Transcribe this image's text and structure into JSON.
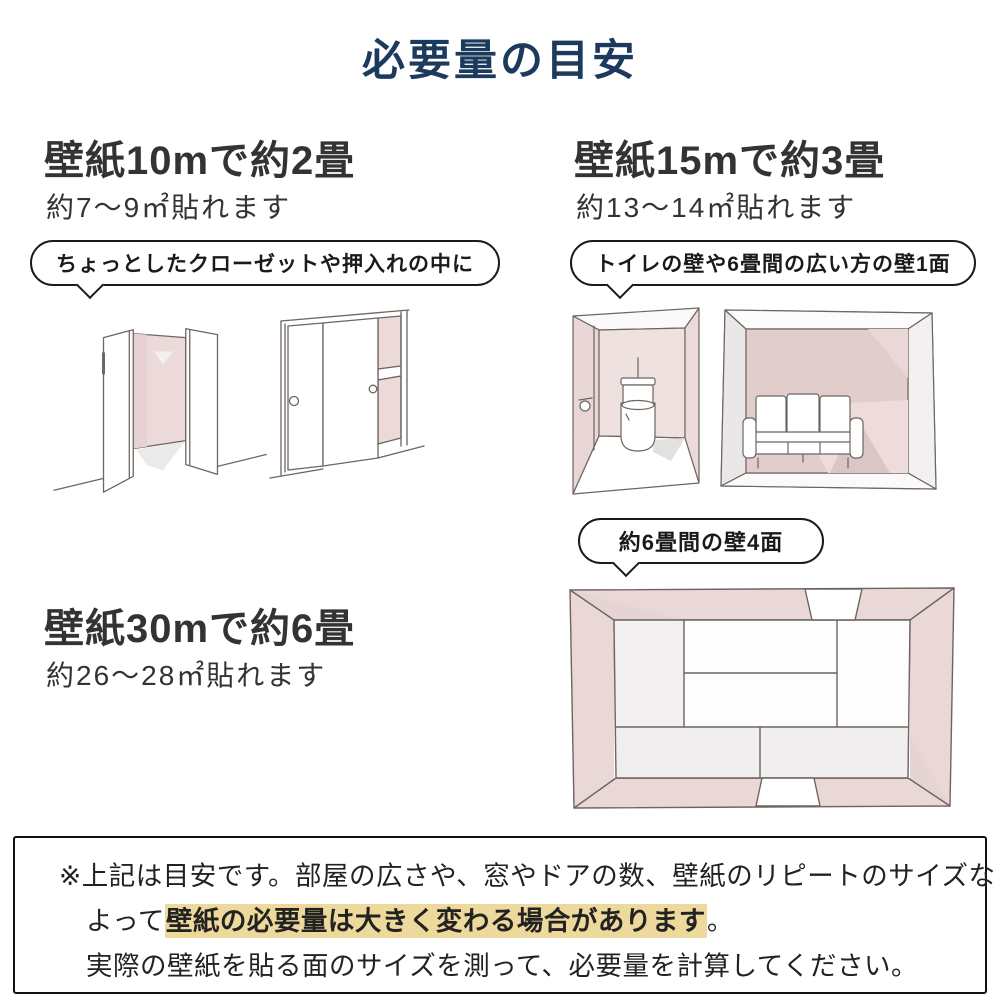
{
  "title": "必要量の目安",
  "sections": {
    "s10": {
      "heading": "壁紙10mで約2畳",
      "sub": "約7～9㎡貼れます",
      "bubble": "ちょっとしたクローゼットや押入れの中に"
    },
    "s15": {
      "heading": "壁紙15mで約3畳",
      "sub": "約13～14㎡貼れます",
      "bubble": "トイレの壁や6畳間の広い方の壁1面"
    },
    "s30": {
      "heading": "壁紙30mで約6畳",
      "sub": "約26～28㎡貼れます",
      "bubble": "約6畳間の壁4面"
    }
  },
  "note": {
    "line1": "※上記は目安です。部屋の広さや、窓やドアの数、壁紙のリピートのサイズなどに",
    "line2_prefix": "よって",
    "line2_highlight": "壁紙の必要量は大きく変わる場合があります",
    "line2_suffix": "。",
    "line3": "実際の壁紙を貼る面のサイズを測って、必要量を計算してください。"
  },
  "colors": {
    "title_navy": "#1c3a5e",
    "text_dark": "#333333",
    "highlight_yellow": "#ecd99b",
    "wall_pink": "#ecdada",
    "wall_pink_dark": "#e2cdcd",
    "sketch_line": "#6d655f"
  },
  "illustrations": {
    "closet_open": "open-double-door-closet-sketch",
    "closet_sliding": "sliding-door-oshiire-closet-sketch",
    "toilet_room": "toilet-room-wall-sketch",
    "sofa_room": "six-tatami-room-one-wall-sketch",
    "tatami_top": "six-tatami-room-top-view-four-walls-sketch"
  }
}
